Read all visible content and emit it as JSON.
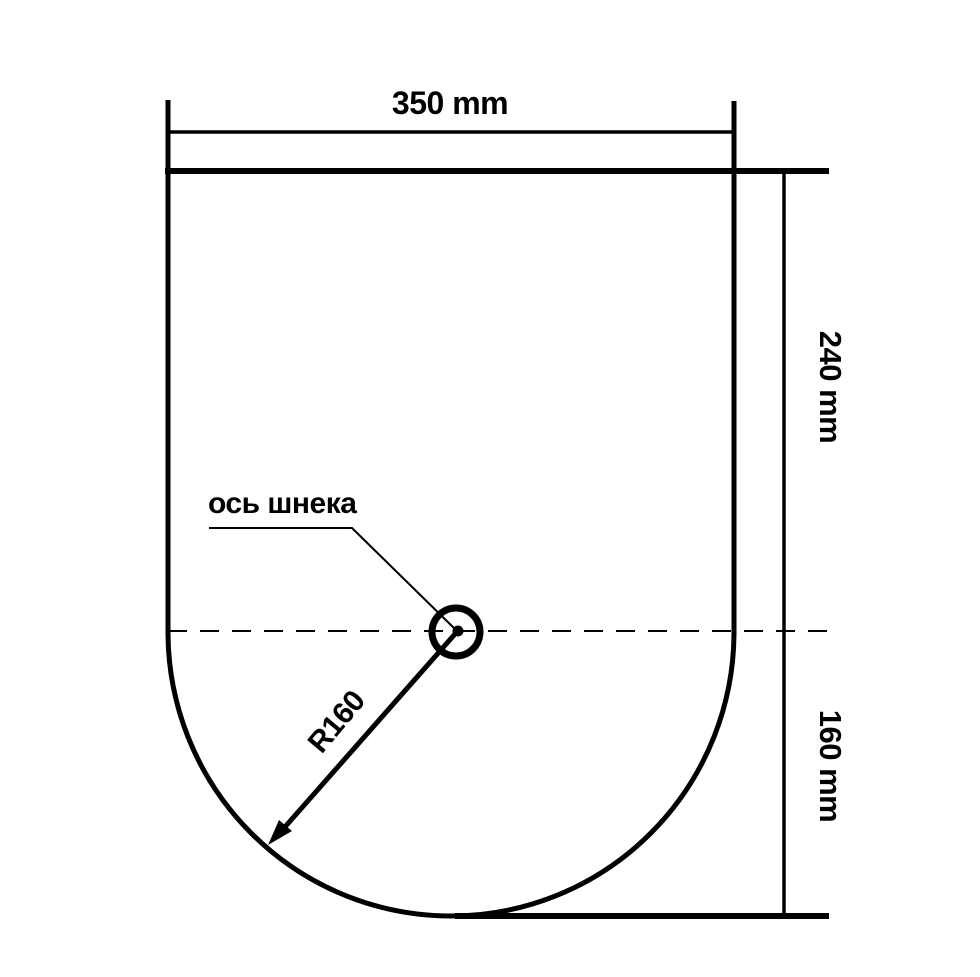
{
  "diagram": {
    "dimension_labels": {
      "width": "350 mm",
      "upper_height": "240 mm",
      "lower_height": "160 mm",
      "radius": "R160"
    },
    "annotations": {
      "auger_axis": "ось шнека"
    },
    "colors": {
      "line": "#000000",
      "background": "#ffffff"
    }
  }
}
